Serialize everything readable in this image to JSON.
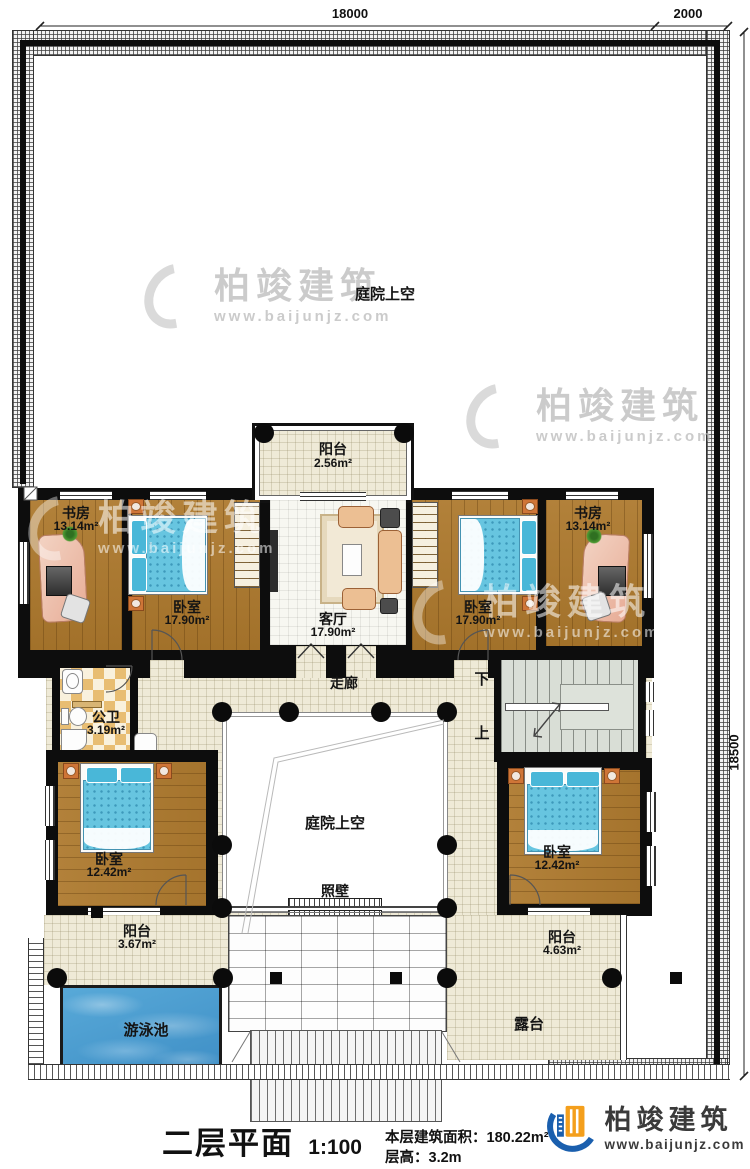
{
  "plan": {
    "dim_top": "18000",
    "dim_top_right": "2000",
    "dim_right": "18500",
    "courtyard_upper": "庭院上空",
    "courtyard_center": "庭院上空",
    "corridor": "走廊",
    "screen_wall": "照壁",
    "stair_down": "下",
    "stair_up": "上",
    "pool": "游泳池",
    "terrace": "露台"
  },
  "rooms": {
    "balcony_top": {
      "label": "阳台",
      "area": "2.56m²"
    },
    "study_left": {
      "label": "书房",
      "area": "13.14m²"
    },
    "bedroom_left": {
      "label": "卧室",
      "area": "17.90m²"
    },
    "living": {
      "label": "客厅",
      "area": "17.90m²"
    },
    "bedroom_right": {
      "label": "卧室",
      "area": "17.90m²"
    },
    "study_right": {
      "label": "书房",
      "area": "13.14m²"
    },
    "bathroom": {
      "label": "公卫",
      "area": "3.19m²"
    },
    "bedroom_lower_left": {
      "label": "卧室",
      "area": "12.42m²"
    },
    "bedroom_lower_right": {
      "label": "卧室",
      "area": "12.42m²"
    },
    "balcony_left": {
      "label": "阳台",
      "area": "3.67m²"
    },
    "balcony_right": {
      "label": "阳台",
      "area": "4.63m²"
    }
  },
  "watermark": {
    "brand": "柏竣建筑",
    "url": "www.baijunjz.com"
  },
  "logo": {
    "brand": "柏竣建筑",
    "url": "www.baijunjz.com"
  },
  "title_block": {
    "title": "二层平面图",
    "scale": "1:100",
    "area_label": "本层建筑面积：",
    "area_value": "180.22m²",
    "floor_height_label": "层高：",
    "floor_height_value": "3.2m"
  }
}
